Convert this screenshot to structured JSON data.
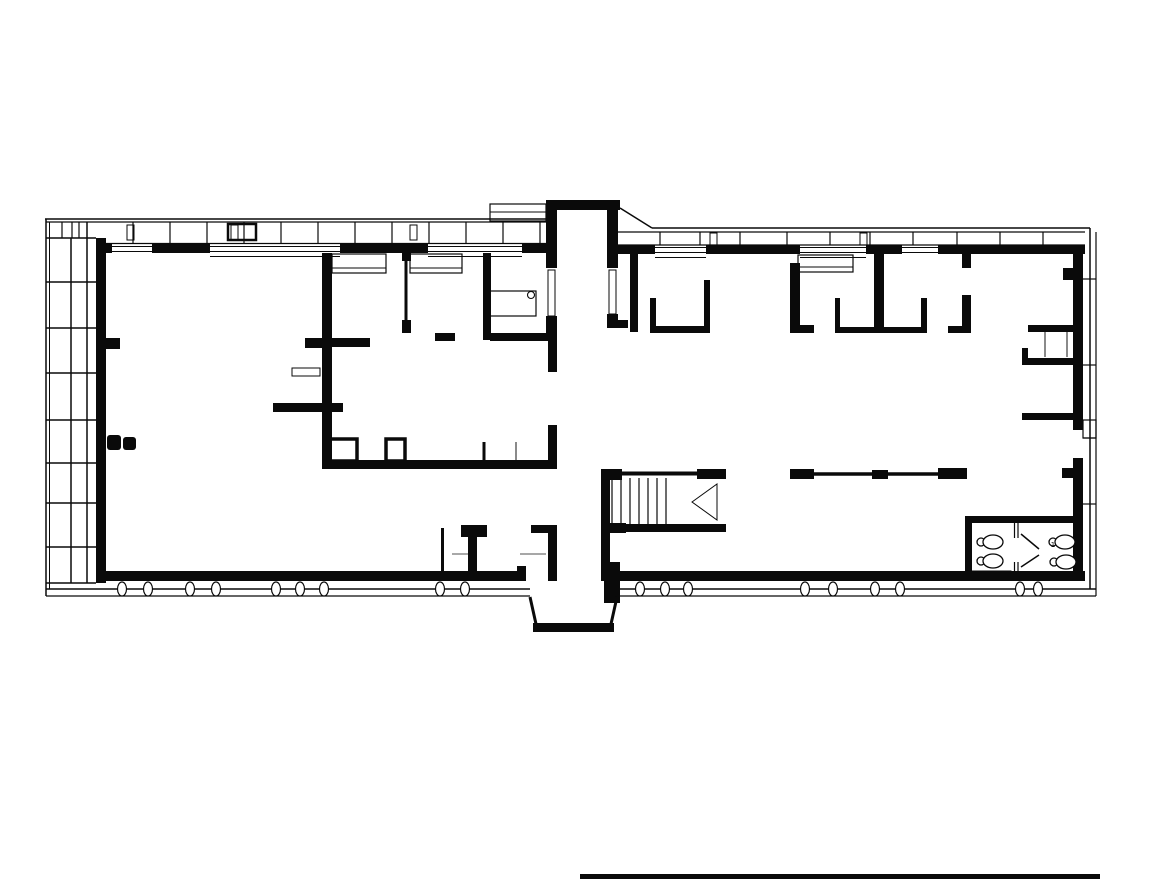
{
  "meta": {
    "title": "building-floor-plan",
    "canvas": {
      "w": 1168,
      "h": 880
    },
    "colors": {
      "bg": "#ffffff",
      "ink": "#0a0a0a",
      "gray": "#8a8a8a",
      "paper": "#ffffff"
    }
  },
  "plan": {
    "walls": [
      [
        96,
        244,
        16,
        9
      ],
      [
        152,
        244,
        58,
        9
      ],
      [
        340,
        244,
        88,
        9
      ],
      [
        522,
        244,
        26,
        9
      ],
      [
        618,
        245,
        37,
        9
      ],
      [
        706,
        245,
        94,
        9
      ],
      [
        866,
        245,
        36,
        9
      ],
      [
        938,
        245,
        147,
        9
      ],
      [
        546,
        200,
        74,
        10
      ],
      [
        546,
        208,
        11,
        60
      ],
      [
        546,
        316,
        11,
        22
      ],
      [
        607,
        208,
        11,
        60
      ],
      [
        607,
        314,
        11,
        14
      ],
      [
        607,
        320,
        21,
        8
      ],
      [
        96,
        238,
        10,
        345
      ],
      [
        106,
        338,
        14,
        11
      ],
      [
        107,
        435,
        14,
        15,
        3
      ],
      [
        123,
        437,
        13,
        13,
        3
      ],
      [
        96,
        571,
        430,
        10
      ],
      [
        517,
        566,
        9,
        15
      ],
      [
        604,
        571,
        481,
        10
      ],
      [
        548,
        533,
        9,
        48
      ],
      [
        1073,
        245,
        10,
        185
      ],
      [
        1073,
        458,
        10,
        123
      ],
      [
        1063,
        268,
        20,
        12
      ],
      [
        1062,
        468,
        21,
        10
      ],
      [
        322,
        253,
        10,
        210
      ],
      [
        305,
        338,
        17,
        10
      ],
      [
        332,
        338,
        38,
        9
      ],
      [
        273,
        403,
        70,
        9
      ],
      [
        402,
        253,
        9,
        8
      ],
      [
        402,
        320,
        9,
        13
      ],
      [
        483,
        253,
        8,
        87
      ],
      [
        435,
        333,
        20,
        8
      ],
      [
        490,
        333,
        65,
        8
      ],
      [
        548,
        332,
        9,
        40
      ],
      [
        548,
        425,
        9,
        42
      ],
      [
        322,
        460,
        235,
        9
      ],
      [
        630,
        253,
        8,
        79
      ],
      [
        650,
        298,
        6,
        34
      ],
      [
        650,
        326,
        60,
        7
      ],
      [
        704,
        280,
        6,
        53
      ],
      [
        790,
        263,
        10,
        69
      ],
      [
        790,
        325,
        24,
        8
      ],
      [
        835,
        298,
        5,
        34
      ],
      [
        835,
        327,
        92,
        6
      ],
      [
        921,
        298,
        6,
        35
      ],
      [
        874,
        245,
        10,
        87
      ],
      [
        962,
        245,
        9,
        23
      ],
      [
        962,
        295,
        9,
        38
      ],
      [
        948,
        326,
        16,
        7
      ],
      [
        1028,
        325,
        46,
        7
      ],
      [
        1022,
        348,
        6,
        17
      ],
      [
        1022,
        358,
        52,
        7
      ],
      [
        1022,
        413,
        52,
        7
      ],
      [
        790,
        469,
        24,
        10
      ],
      [
        872,
        470,
        16,
        9
      ],
      [
        938,
        468,
        29,
        11
      ],
      [
        601,
        469,
        9,
        112
      ],
      [
        601,
        469,
        21,
        11
      ],
      [
        697,
        469,
        29,
        10
      ],
      [
        601,
        523,
        25,
        10
      ],
      [
        601,
        524,
        125,
        8
      ],
      [
        604,
        562,
        16,
        41
      ],
      [
        461,
        525,
        26,
        12
      ],
      [
        468,
        537,
        9,
        34
      ],
      [
        531,
        525,
        26,
        8
      ],
      [
        533,
        623,
        81,
        9
      ],
      [
        965,
        516,
        117,
        7
      ],
      [
        965,
        516,
        7,
        65
      ],
      [
        580,
        874,
        520,
        5
      ]
    ],
    "lines": [
      [
        112,
        246.5,
        152,
        246.5,
        1
      ],
      [
        112,
        251.5,
        152,
        251.5,
        1
      ],
      [
        210,
        246.5,
        340,
        246.5,
        1
      ],
      [
        210,
        251.5,
        340,
        251.5,
        1
      ],
      [
        428,
        246.5,
        522,
        246.5,
        1
      ],
      [
        428,
        251.5,
        522,
        251.5,
        1
      ],
      [
        655,
        247.5,
        706,
        247.5,
        1
      ],
      [
        655,
        252.5,
        706,
        252.5,
        1
      ],
      [
        800,
        247.5,
        866,
        247.5,
        1
      ],
      [
        800,
        252.5,
        866,
        252.5,
        1
      ],
      [
        902,
        247.5,
        938,
        247.5,
        1
      ],
      [
        902,
        252.5,
        938,
        252.5,
        1
      ],
      [
        210,
        256.5,
        340,
        256.5,
        1
      ],
      [
        428,
        256.5,
        522,
        256.5,
        1
      ],
      [
        655,
        257.5,
        706,
        257.5,
        1
      ],
      [
        800,
        257.5,
        866,
        257.5,
        1
      ],
      [
        406,
        253,
        406,
        333,
        3
      ],
      [
        484,
        442,
        484,
        460,
        3
      ],
      [
        792,
        474,
        965,
        474,
        3.5
      ],
      [
        622,
        473.5,
        726,
        473.5,
        4
      ],
      [
        612,
        478,
        612,
        524,
        1.2
      ],
      [
        621,
        478,
        621,
        524,
        1.2
      ],
      [
        630,
        478,
        630,
        524,
        1.2
      ],
      [
        639,
        478,
        639,
        524,
        1.2
      ],
      [
        648,
        478,
        648,
        524,
        1.2
      ],
      [
        657,
        478,
        657,
        524,
        1.2
      ],
      [
        666,
        478,
        666,
        524,
        1.2
      ],
      [
        442.5,
        528,
        442.5,
        571,
        3
      ],
      [
        530,
        597,
        536,
        624,
        3
      ],
      [
        617,
        597,
        611,
        624,
        3
      ],
      [
        1014.5,
        523,
        1014.5,
        538,
        1.2
      ],
      [
        1018,
        523,
        1018,
        538,
        1.2
      ],
      [
        1014.5,
        562,
        1014.5,
        577,
        1.2
      ],
      [
        1018,
        562,
        1018,
        577,
        1.2
      ],
      [
        1021,
        534,
        1039,
        549,
        1.5
      ],
      [
        1021,
        567,
        1039,
        555,
        1.5
      ],
      [
        45,
        219,
        546,
        219,
        1.5
      ],
      [
        620,
        208,
        652,
        228,
        1.5
      ],
      [
        652,
        228,
        1090,
        228,
        1.5
      ],
      [
        1090,
        228,
        1090,
        589,
        1.5
      ],
      [
        1096,
        232,
        1096,
        596,
        1.2
      ],
      [
        46,
        219,
        46,
        596,
        1.5
      ],
      [
        49.5,
        222,
        49.5,
        589,
        1
      ],
      [
        46,
        589,
        530,
        589,
        1.5
      ],
      [
        615,
        589,
        1096,
        589,
        1.5
      ],
      [
        46,
        596,
        530,
        596,
        1.2
      ],
      [
        615,
        596,
        1096,
        596,
        1.2
      ],
      [
        71,
        238,
        71,
        583,
        1.5
      ],
      [
        87,
        222,
        87,
        583,
        1.5
      ],
      [
        46,
        222,
        96,
        222,
        1.2
      ],
      [
        46,
        238,
        96,
        238,
        1.5
      ],
      [
        46,
        282,
        96,
        282,
        1.5
      ],
      [
        46,
        328,
        96,
        328,
        1.5
      ],
      [
        46,
        373,
        96,
        373,
        1.5
      ],
      [
        46,
        420,
        96,
        420,
        1.5
      ],
      [
        46,
        463,
        96,
        463,
        1.5
      ],
      [
        46,
        503,
        96,
        503,
        1.5
      ],
      [
        46,
        547,
        96,
        547,
        1.5
      ],
      [
        46,
        583,
        96,
        583,
        1.5
      ],
      [
        62,
        222,
        62,
        238,
        1.2
      ],
      [
        72,
        222,
        72,
        238,
        1.2
      ],
      [
        79,
        222,
        79,
        238,
        1.2
      ],
      [
        1083,
        279,
        1096,
        279,
        1.2
      ],
      [
        1083,
        365,
        1096,
        365,
        1.2
      ],
      [
        1083,
        438,
        1096,
        438,
        1.2
      ],
      [
        1083,
        504,
        1096,
        504,
        1.2
      ],
      [
        96,
        222,
        546,
        222,
        1.2
      ],
      [
        96,
        243.5,
        546,
        243.5,
        1.2
      ],
      [
        133,
        222,
        133,
        243.5,
        1.2
      ],
      [
        170,
        222,
        170,
        243.5,
        1.2
      ],
      [
        207,
        222,
        207,
        243.5,
        1.2
      ],
      [
        244,
        222,
        244,
        243.5,
        1.2
      ],
      [
        281,
        222,
        281,
        243.5,
        1.2
      ],
      [
        318,
        222,
        318,
        243.5,
        1.2
      ],
      [
        355,
        222,
        355,
        243.5,
        1.2
      ],
      [
        392,
        222,
        392,
        243.5,
        1.2
      ],
      [
        429,
        222,
        429,
        243.5,
        1.2
      ],
      [
        466,
        222,
        466,
        243.5,
        1.2
      ],
      [
        503,
        222,
        503,
        243.5,
        1.2
      ],
      [
        540,
        222,
        540,
        243.5,
        1.2
      ],
      [
        618,
        232,
        1085,
        232,
        1.2
      ],
      [
        618,
        245,
        1085,
        245,
        1.2
      ],
      [
        660,
        232,
        660,
        245,
        1.2
      ],
      [
        700,
        232,
        700,
        245,
        1.2
      ],
      [
        740,
        232,
        740,
        245,
        1.2
      ],
      [
        787,
        232,
        787,
        245,
        1.2
      ],
      [
        830,
        232,
        830,
        245,
        1.2
      ],
      [
        870,
        232,
        870,
        245,
        1.2
      ],
      [
        913,
        232,
        913,
        245,
        1.2
      ],
      [
        957,
        232,
        957,
        245,
        1.2
      ],
      [
        1000,
        232,
        1000,
        245,
        1.2
      ],
      [
        1043,
        232,
        1043,
        245,
        1.2
      ],
      [
        490,
        212,
        546,
        212,
        1
      ],
      [
        332,
        268,
        386,
        268,
        1
      ],
      [
        410,
        268,
        462,
        268,
        1
      ],
      [
        798,
        267,
        853,
        267,
        1
      ]
    ],
    "gray_lines": [
      [
        516,
        442,
        516,
        460,
        2
      ],
      [
        1045,
        332,
        1045,
        357,
        2
      ],
      [
        1067,
        332,
        1067,
        357,
        2
      ],
      [
        452,
        554,
        468,
        554,
        1.5
      ],
      [
        520,
        554,
        546,
        554,
        1.5
      ]
    ],
    "outlines": [
      [
        329,
        439,
        28,
        22,
        3.5
      ],
      [
        386,
        439,
        19,
        22,
        3.5
      ],
      [
        548,
        270,
        7,
        46,
        1
      ],
      [
        609,
        270,
        7,
        44,
        1
      ],
      [
        490,
        204,
        56,
        17,
        1.2
      ],
      [
        332,
        254,
        54,
        19,
        1.2
      ],
      [
        410,
        254,
        52,
        19,
        1.2
      ],
      [
        798,
        255,
        55,
        17,
        1.2
      ],
      [
        488,
        291,
        48,
        25,
        1.2
      ],
      [
        292,
        368,
        28,
        8,
        1
      ],
      [
        1083,
        420,
        13,
        18,
        1.2
      ],
      [
        127,
        225,
        7,
        15,
        1
      ],
      [
        231,
        225,
        7,
        15,
        1
      ],
      [
        410,
        225,
        7,
        15,
        1
      ],
      [
        710,
        233,
        7,
        12,
        1
      ],
      [
        860,
        233,
        7,
        12,
        1
      ],
      [
        228,
        224,
        28,
        16,
        2.5
      ],
      [
        967,
        571,
        44,
        7,
        1
      ]
    ],
    "polygons": [
      {
        "name": "stair-direction-triangle",
        "points": [
          [
            692,
            502
          ],
          [
            717,
            484
          ],
          [
            717,
            520
          ]
        ]
      }
    ],
    "facade_ovals": {
      "cy": 589,
      "rx": 4.5,
      "ry": 7,
      "cx": [
        122,
        148,
        190,
        216,
        276,
        300,
        324,
        440,
        465,
        640,
        665,
        688,
        805,
        833,
        875,
        900,
        1020,
        1038
      ]
    },
    "circles": [
      {
        "name": "desk-stool",
        "cx": 531,
        "cy": 295,
        "r": 3.5
      }
    ],
    "toilets": [
      {
        "cx": 990,
        "cy": 542
      },
      {
        "cx": 990,
        "cy": 561
      },
      {
        "cx": 1062,
        "cy": 542
      },
      {
        "cx": 1063,
        "cy": 562
      }
    ],
    "labels": [
      {
        "x": 1053,
        "y": 545,
        "text": "1",
        "size": 7
      }
    ]
  }
}
